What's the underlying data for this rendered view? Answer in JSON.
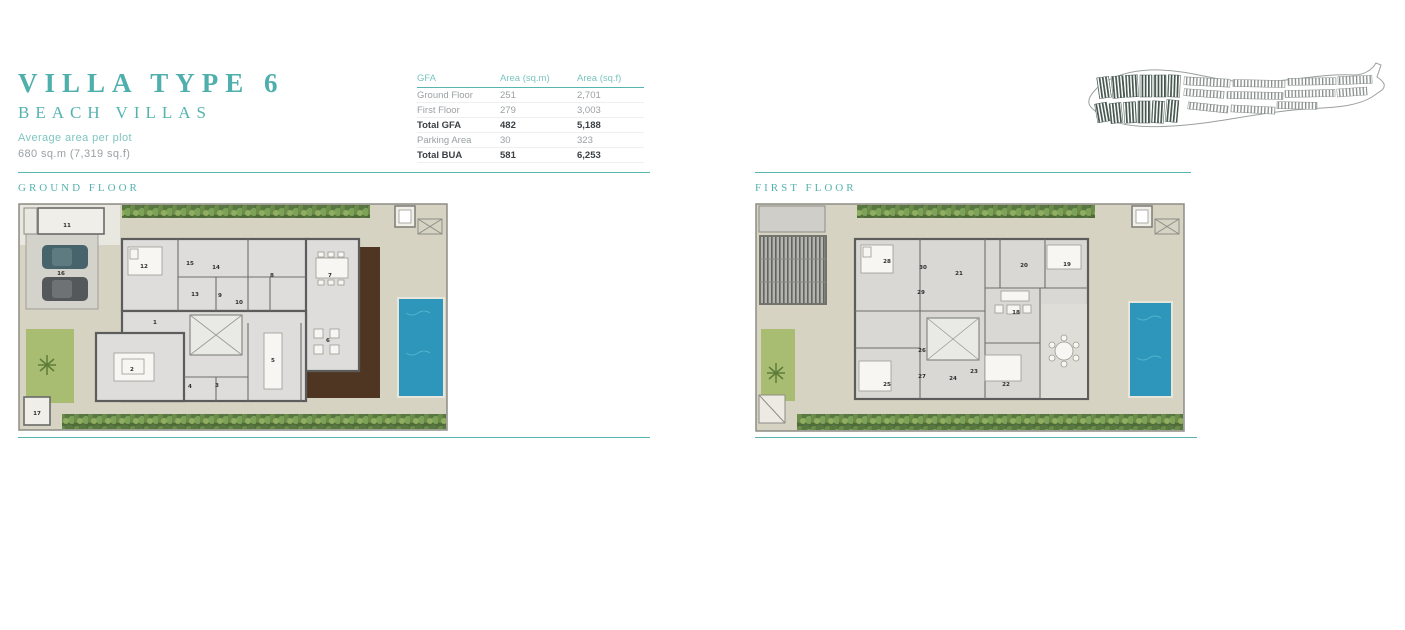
{
  "header": {
    "title": "VILLA TYPE 6",
    "subtitle": "BEACH VILLAS",
    "avg_area_label": "Average area per plot",
    "avg_area_value": "680 sq.m (7,319 sq.f)"
  },
  "gfa_table": {
    "headers": [
      "GFA",
      "Area (sq.m)",
      "Area (sq.f)"
    ],
    "rows": [
      {
        "label": "Ground Floor",
        "sqm": "251",
        "sqf": "2,701"
      },
      {
        "label": "First Floor",
        "sqm": "279",
        "sqf": "3,003"
      },
      {
        "label": "Total GFA",
        "sqm": "482",
        "sqf": "5,188"
      },
      {
        "label": "Parking Area",
        "sqm": "30",
        "sqf": "323"
      },
      {
        "label": "Total BUA",
        "sqm": "581",
        "sqf": "6,253"
      }
    ]
  },
  "sections": {
    "ground": {
      "label": "GROUND FLOOR"
    },
    "first": {
      "label": "FIRST FLOOR"
    }
  },
  "floor_plans": [
    {
      "id": "ground",
      "rooms": [
        {
          "n": "1",
          "x": 137,
          "y": 121
        },
        {
          "n": "2",
          "x": 114,
          "y": 168
        },
        {
          "n": "3",
          "x": 199,
          "y": 184
        },
        {
          "n": "4",
          "x": 172,
          "y": 185
        },
        {
          "n": "5",
          "x": 255,
          "y": 159
        },
        {
          "n": "6",
          "x": 310,
          "y": 139
        },
        {
          "n": "7",
          "x": 312,
          "y": 74
        },
        {
          "n": "8",
          "x": 254,
          "y": 74
        },
        {
          "n": "9",
          "x": 202,
          "y": 94
        },
        {
          "n": "10",
          "x": 221,
          "y": 101
        },
        {
          "n": "11",
          "x": 49,
          "y": 24
        },
        {
          "n": "12",
          "x": 126,
          "y": 65
        },
        {
          "n": "13",
          "x": 177,
          "y": 93
        },
        {
          "n": "14",
          "x": 198,
          "y": 66
        },
        {
          "n": "15",
          "x": 172,
          "y": 62
        },
        {
          "n": "16",
          "x": 43,
          "y": 72
        },
        {
          "n": "17",
          "x": 19,
          "y": 212
        }
      ]
    },
    {
      "id": "first",
      "rooms": [
        {
          "n": "18",
          "x": 261,
          "y": 111
        },
        {
          "n": "19",
          "x": 312,
          "y": 63
        },
        {
          "n": "20",
          "x": 269,
          "y": 64
        },
        {
          "n": "21",
          "x": 204,
          "y": 72
        },
        {
          "n": "22",
          "x": 251,
          "y": 183
        },
        {
          "n": "23",
          "x": 219,
          "y": 170
        },
        {
          "n": "24",
          "x": 198,
          "y": 177
        },
        {
          "n": "25",
          "x": 132,
          "y": 183
        },
        {
          "n": "26",
          "x": 167,
          "y": 149
        },
        {
          "n": "27",
          "x": 167,
          "y": 175
        },
        {
          "n": "28",
          "x": 132,
          "y": 60
        },
        {
          "n": "29",
          "x": 166,
          "y": 91
        },
        {
          "n": "30",
          "x": 168,
          "y": 66
        }
      ]
    }
  ],
  "site_map": {
    "name": "master-plan-location-map"
  },
  "colors": {
    "accent_teal": "#4FAFAC",
    "teal_light": "#7CC4BF",
    "text_gray": "#9BA0A3",
    "text_dark": "#3B4045",
    "pool_blue": "#2E96BA",
    "deck_brown": "#4F3622",
    "hedge_green": "#4F6B3A",
    "lawn_green": "#A8BD72",
    "plot_beige": "#D6D3C3",
    "wall_gray": "#5C5C5C"
  }
}
